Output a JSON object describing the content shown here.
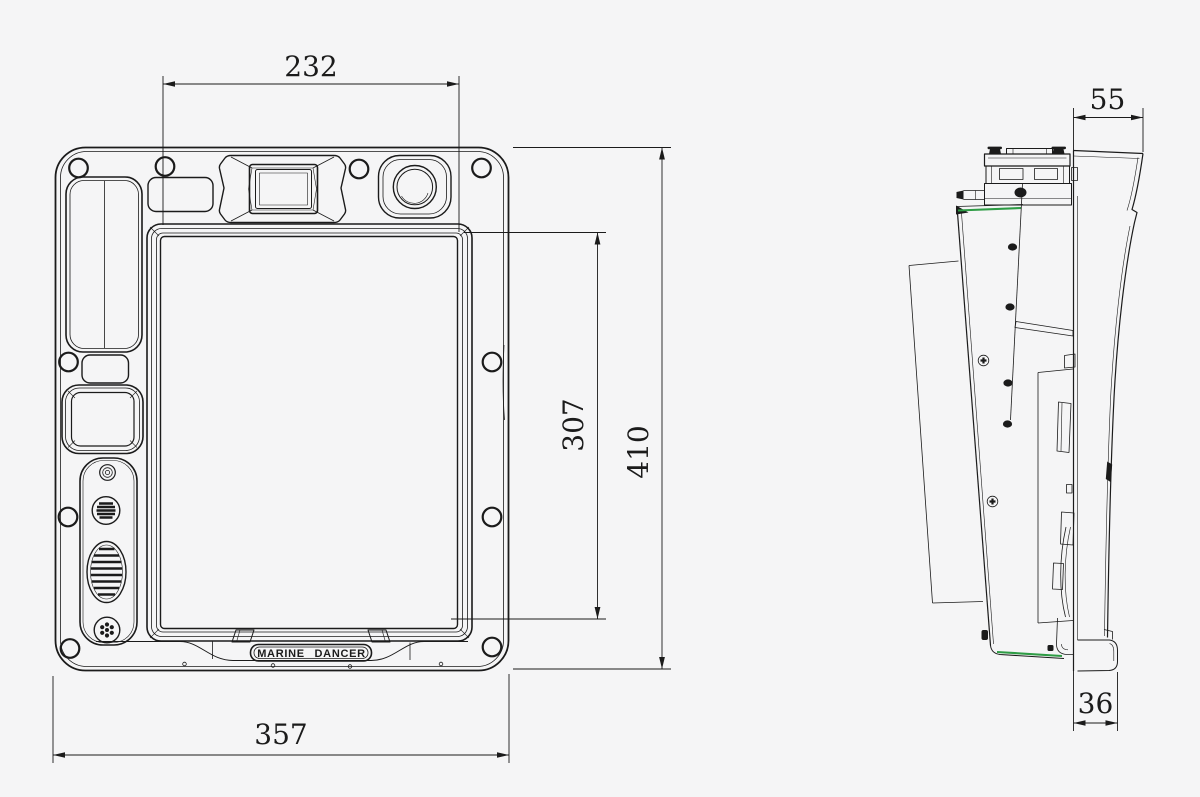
{
  "colors": {
    "bg": "#f5f5f6",
    "ln": "#1b1b1b",
    "green": "#2e9c45"
  },
  "label": {
    "text": "MARINE DANCER"
  },
  "dimensions": {
    "d232": {
      "value": "232"
    },
    "d307": {
      "value": "307"
    },
    "d410": {
      "value": "410"
    },
    "d357": {
      "value": "357"
    },
    "d55": {
      "value": "55"
    },
    "d36": {
      "value": "36"
    }
  }
}
